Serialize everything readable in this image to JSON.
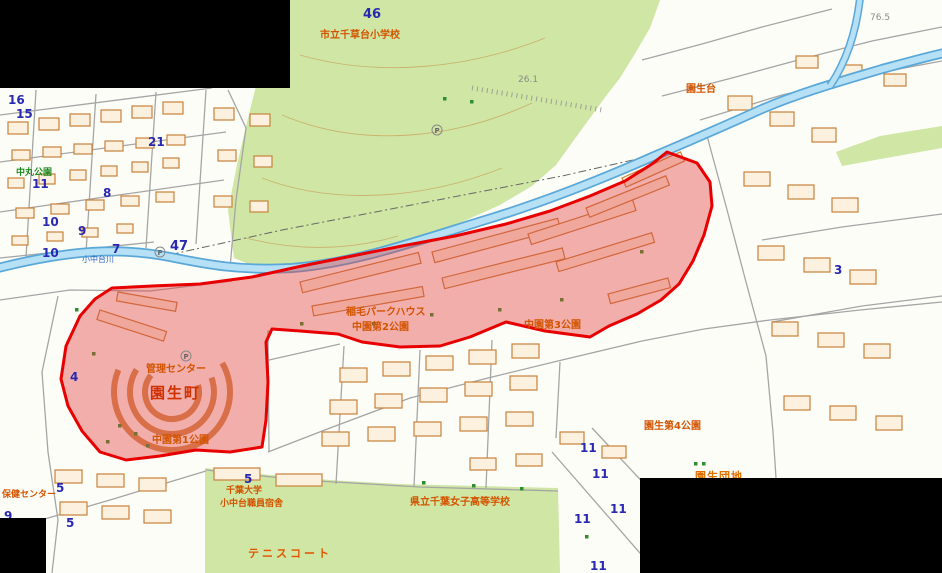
{
  "map": {
    "highlight": {
      "area_name": "園生町",
      "border_color": "#e80000",
      "fill_color": "rgba(224,64,64,0.42)"
    },
    "colors": {
      "park_green": "#cfe6a4",
      "river_blue": "#b5e0f5",
      "river_edge": "#5aa8d8",
      "building_outline": "#c8823a",
      "label_orange": "#d35400",
      "label_blue": "#2828b0",
      "redaction_black": "#000000"
    },
    "labels": {
      "school_north": "市立千草台小学校",
      "nakamaru_park": "中丸公園",
      "river_name": "小中台川",
      "park_house": "稲毛パークハウス",
      "nakazono2_park": "中園第2公園",
      "nakazono3_park": "中園第3公園",
      "nakazono1_park": "中園第1公園",
      "mgmt_center": "管理センター",
      "sonno_town": "園生町",
      "sonnodai": "園生台",
      "sonno4_park": "園生第4公園",
      "sonno_danchi": "園生団地",
      "health_center": "保健センター",
      "chiba_univ": "千葉大学",
      "univ_dorm": "小中台職員宿舎",
      "girls_school": "県立千葉女子高等学校",
      "tennis_court": "テニスコート"
    },
    "elevations": [
      "26.1",
      "76.5"
    ],
    "nums": [
      "46",
      "16",
      "15",
      "21",
      "11",
      "8",
      "10",
      "9",
      "47",
      "7",
      "10",
      "4",
      "5",
      "5",
      "9",
      "5",
      "11",
      "11",
      "11",
      "11",
      "11",
      "3"
    ],
    "symbols": {
      "parking": "P"
    }
  }
}
